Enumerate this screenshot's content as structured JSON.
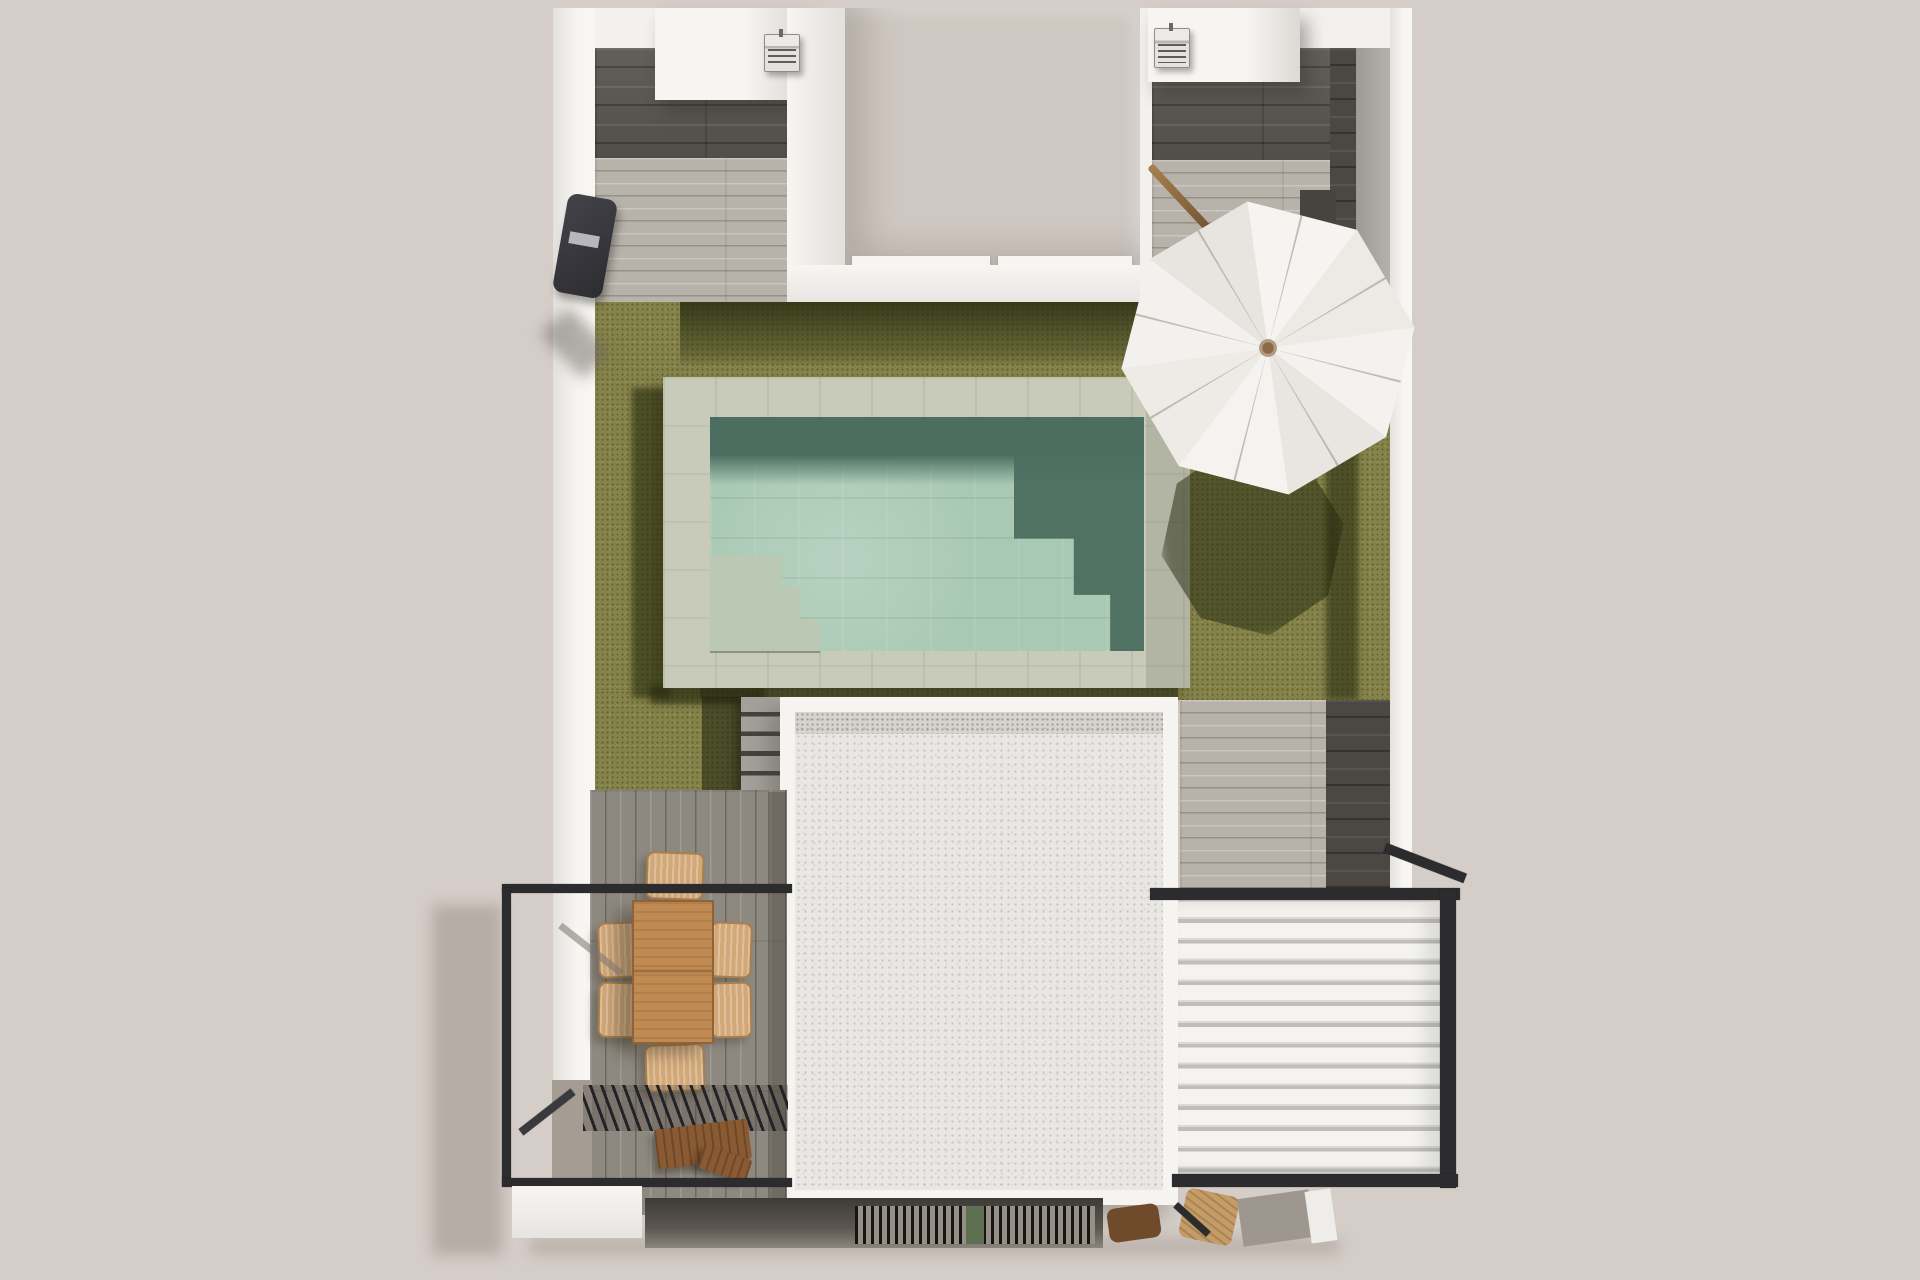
{
  "scene": {
    "type": "3d-architectural-render-top-view",
    "objects": [
      {
        "name": "villa-plot",
        "parts": [
          "left-wing",
          "right-wing",
          "central-courtyard",
          "main-roof"
        ]
      },
      {
        "name": "left-wing-roof",
        "equipment": "ac-unit"
      },
      {
        "name": "right-wing-roof",
        "equipment": "ac-unit"
      },
      {
        "name": "central-courtyard",
        "features": [
          "door-thresholds"
        ]
      },
      {
        "name": "swimming-pool",
        "features": [
          "stone-deck",
          "water",
          "corner-steps",
          "shadow-on-water"
        ]
      },
      {
        "name": "garden-lawn",
        "features": [
          "house-shadow",
          "umbrella-shadow"
        ]
      },
      {
        "name": "parasol-umbrella",
        "shape": "octagonal",
        "ribs": 8,
        "accessory": "tilted-wooden-pole"
      },
      {
        "name": "main-house-roof",
        "finish": "white-gravel-texture"
      },
      {
        "name": "garden-steps",
        "treads": 5
      },
      {
        "name": "dining-terrace",
        "furniture": [
          "wooden-table",
          "six-wicker-chairs",
          "wooden-bench"
        ]
      },
      {
        "name": "dining-pergola-slatted",
        "finish": "dark-slats"
      },
      {
        "name": "balcony-railing",
        "finish": "dark-metal-frame"
      },
      {
        "name": "louvred-pergola",
        "slats": 13,
        "finish": "white-louvres-dark-frame"
      },
      {
        "name": "bbq-grill-strip"
      },
      {
        "name": "wooden-loungers"
      },
      {
        "name": "outdoor-shower-unit"
      }
    ]
  },
  "palette": {
    "background": "#d5cdc8",
    "wall_white": "#f4f3f0",
    "courtyard_floor": "#d0c8c2",
    "tile_dark": "#5a5751",
    "plank_light": "#b7b2aa",
    "plank_terrace": "#8e8980",
    "lawn": "#85834a",
    "lawn_shadow": "#242a0e",
    "pool_deck": "#c9cbba",
    "water": "#a9c9b4",
    "water_shadow": "#4b6e60",
    "roof_white": "#e9e7e3",
    "frame_dark": "#2c2c2f",
    "louvre_white": "#f3f2ef",
    "wood_table": "#c08a52",
    "wood_chair": "#d2a878",
    "wood_bench": "#8a5a32",
    "umbrella": "#f3f1ee",
    "umbrella_hub": "#8a6a4c"
  }
}
